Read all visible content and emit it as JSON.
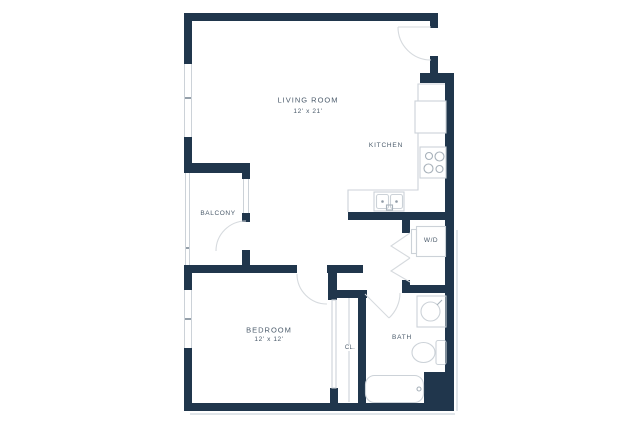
{
  "meta": {
    "type": "apartment-floor-plan",
    "style": "one-bedroom unit"
  },
  "colors": {
    "wall": "#20364c",
    "line": "#ccd2d8",
    "arc": "#d6dade",
    "label": "#4b5b6b",
    "tick": "#95a0aa",
    "fixture": "#a7b1ba"
  },
  "rooms": {
    "living_room": {
      "label": "LIVING ROOM",
      "dimensions": "12' x 21'"
    },
    "kitchen": {
      "label": "KITCHEN"
    },
    "balcony": {
      "label": "BALCONY"
    },
    "bedroom": {
      "label": "BEDROOM",
      "dimensions": "12' x 12'"
    },
    "closet": {
      "label": "CL."
    },
    "bath": {
      "label": "BATH"
    },
    "laundry": {
      "label": "W/D"
    }
  }
}
